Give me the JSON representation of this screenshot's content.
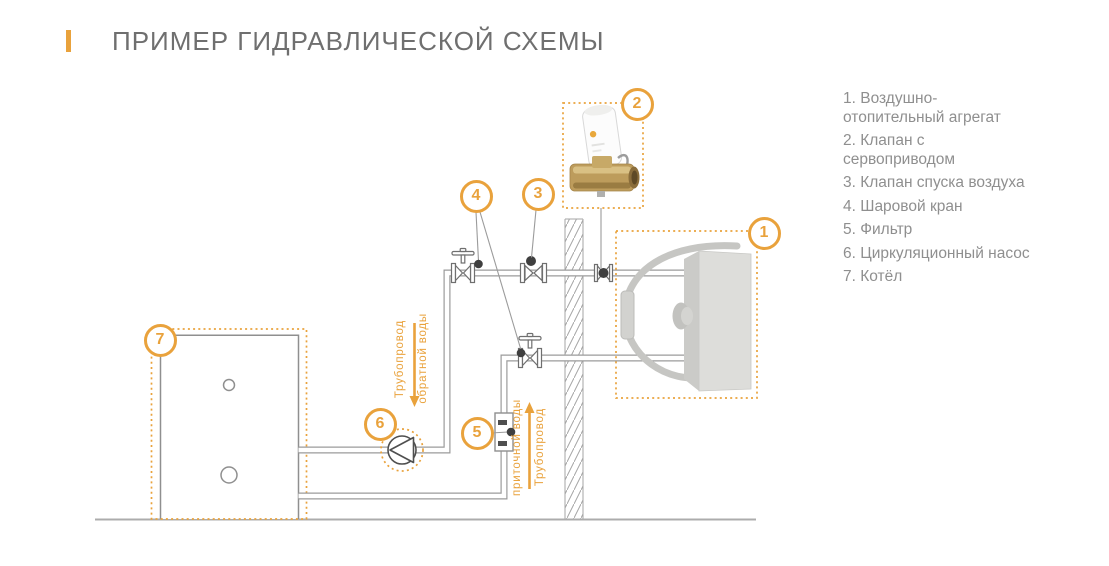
{
  "header": {
    "title": "ПРИМЕР ГИДРАВЛИЧЕСКОЙ СХЕМЫ"
  },
  "legend": {
    "items": [
      {
        "lines": [
          "1. Воздушно-",
          "отопительный агрегат"
        ]
      },
      {
        "lines": [
          "2. Клапан с",
          "сервоприводом"
        ]
      },
      {
        "lines": [
          "3. Клапан спуска воздуха"
        ]
      },
      {
        "lines": [
          "4. Шаровой кран"
        ]
      },
      {
        "lines": [
          "5. Фильтр"
        ]
      },
      {
        "lines": [
          "6. Циркуляционный насос"
        ]
      },
      {
        "lines": [
          "7. Котёл"
        ]
      }
    ]
  },
  "diagram": {
    "badges": [
      {
        "label": "1"
      },
      {
        "label": "2"
      },
      {
        "label": "3"
      },
      {
        "label": "4"
      },
      {
        "label": "5"
      },
      {
        "label": "6"
      },
      {
        "label": "7"
      }
    ],
    "pipe_labels": {
      "return": {
        "lines": [
          "Трубопровод",
          "обратной воды"
        ],
        "direction": "down"
      },
      "supply": {
        "lines": [
          "Трубопровод",
          "приточной воды"
        ],
        "direction": "up"
      }
    }
  },
  "colors": {
    "accent": "#E9A23C",
    "line": "#9B9B9B",
    "dark": "#3F3F3F",
    "title_text": "#6F6F6F",
    "legend_text": "#8F8F8F"
  }
}
